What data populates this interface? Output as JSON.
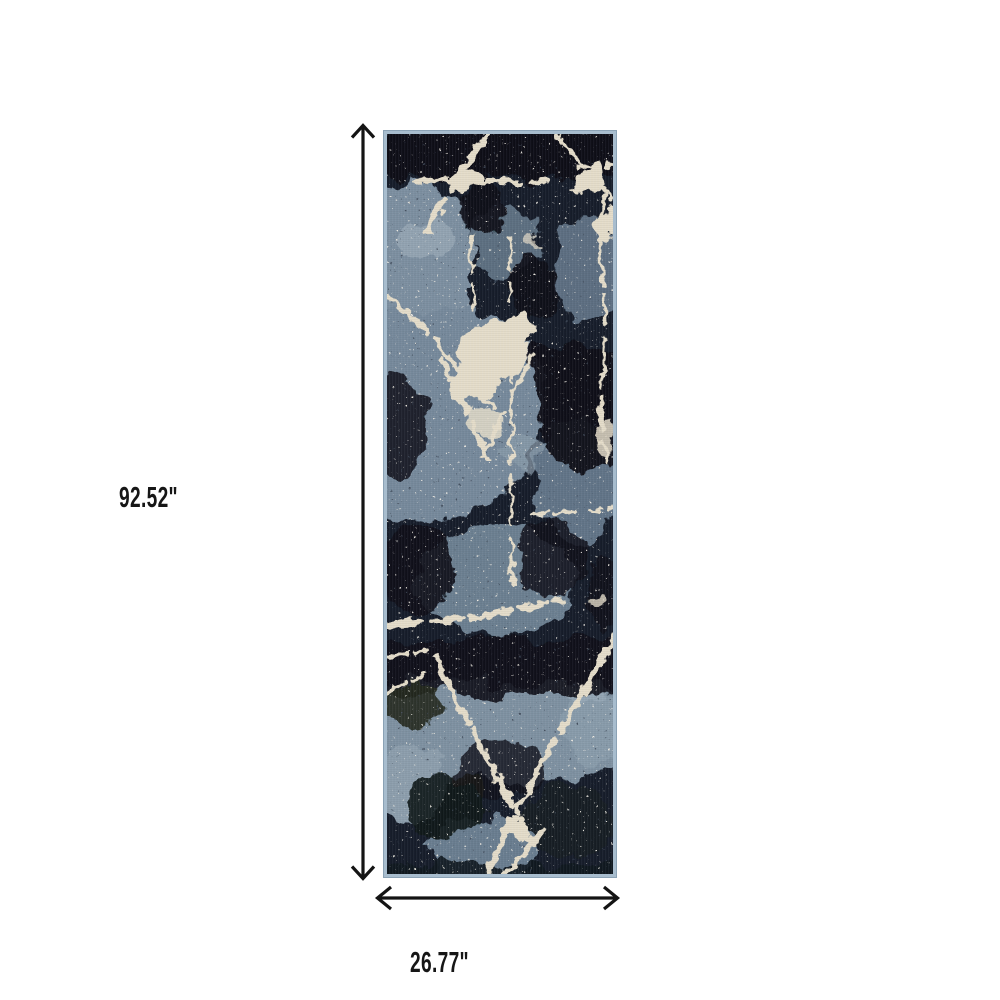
{
  "dimensions": {
    "height_label": "92.52\"",
    "width_label": "26.77\""
  },
  "icons": {
    "arrow_up": "chevron-up-arrowhead",
    "arrow_down": "chevron-down-arrowhead",
    "arrow_left": "chevron-left-arrowhead",
    "arrow_right": "chevron-right-arrowhead"
  },
  "colors": {
    "page_background": "#ffffff",
    "arrow": "#141414",
    "label_text": "#161616",
    "rug_base_navy": "#151c29",
    "rug_dark": "#0c1119",
    "rug_slate": "#76899b",
    "rug_slate_light": "#97a8b5",
    "rug_cream": "#e5ddca",
    "rug_edge_blue": "#a8bdce"
  }
}
